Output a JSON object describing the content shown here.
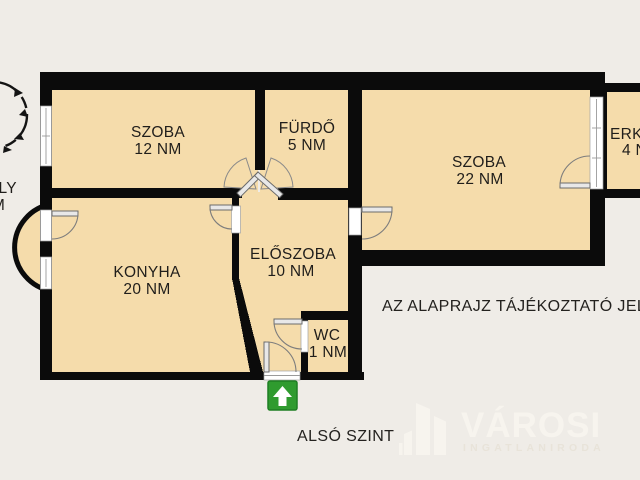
{
  "colors": {
    "background": "#efece7",
    "room_fill": "#f5dcab",
    "wall": "#0b0b0b",
    "label_text": "#201e1b",
    "entrance_green": "#2f9b2f",
    "watermark": "#f7f4ee",
    "watermark_subtitle": "#e8e3d9"
  },
  "rooms": [
    {
      "id": "szoba-12",
      "name": "SZOBA",
      "area": "12 NM"
    },
    {
      "id": "furdo",
      "name": "FÜRDŐ",
      "area": "5 NM"
    },
    {
      "id": "szoba-22",
      "name": "SZOBA",
      "area": "22 NM"
    },
    {
      "id": "erkely-4",
      "name": "ERKÉLY",
      "area": "4 NM"
    },
    {
      "id": "konyha",
      "name": "KONYHA",
      "area": "20 NM"
    },
    {
      "id": "eloszoba",
      "name": "ELŐSZOBA",
      "area": "10 NM"
    },
    {
      "id": "wc",
      "name": "WC",
      "area": "1 NM"
    },
    {
      "id": "erkely-1",
      "name": "ERKÉLY",
      "area": "1 NM"
    }
  ],
  "disclaimer": "AZ ALAPRAJZ TÁJÉKOZTATÓ JELLEGŰ",
  "floor_label": "ALSÓ SZINT",
  "watermark": {
    "brand": "VÁROSI",
    "subtitle": "INGATLANIRODA"
  },
  "icons": {
    "entrance_arrow": "up-arrow",
    "stair_circle": "spiral-staircase"
  }
}
